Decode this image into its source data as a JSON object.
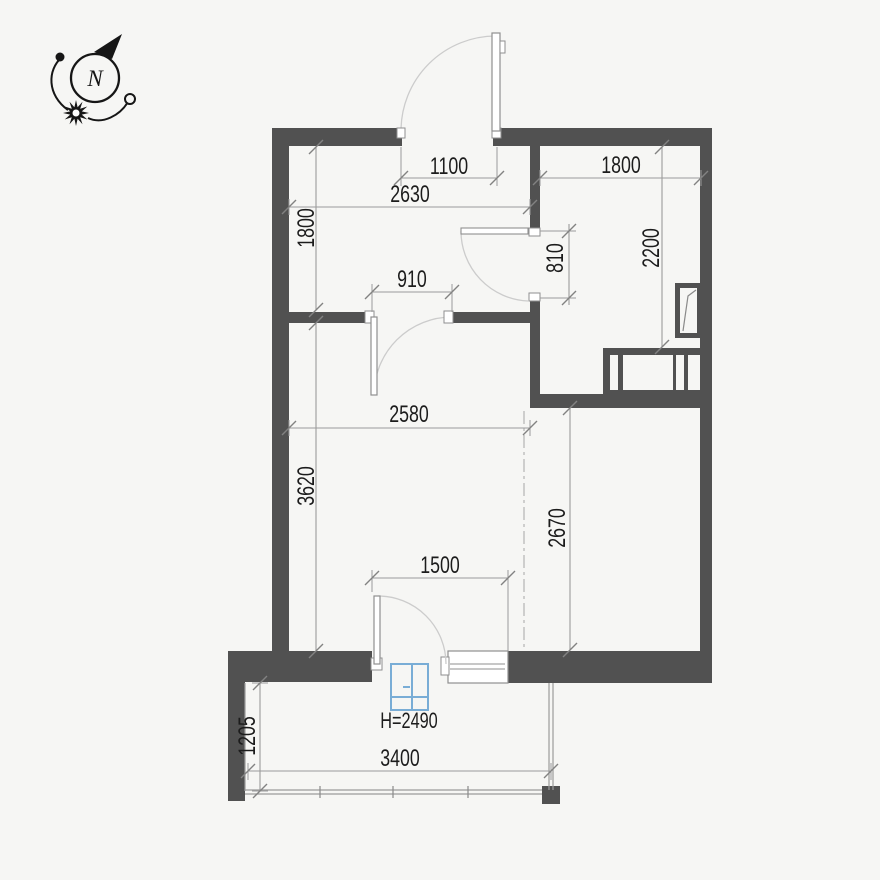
{
  "plan_type": "apartment-floor-plan",
  "compass": {
    "north_label": "N"
  },
  "colors": {
    "wall": "#515151",
    "background": "#f6f6f4",
    "dimension_line": "#9b9b9b",
    "dimension_text": "#1c1c1c",
    "door_arc": "#cccccc",
    "glazing_symbol_blue": "#79add6"
  },
  "dimensions": {
    "entry_opening": "1100",
    "hall_width": "2630",
    "hall_depth": "1800",
    "room_width": "1800",
    "room_depth": "2200",
    "room_door_opening": "810",
    "interior_door_opening": "910",
    "living_width": "2580",
    "living_depth": "3620",
    "zone_depth": "2670",
    "balcony_door_opening": "1500",
    "balcony_depth": "1205",
    "balcony_width": "3400",
    "glazing_height": "H=2490"
  }
}
